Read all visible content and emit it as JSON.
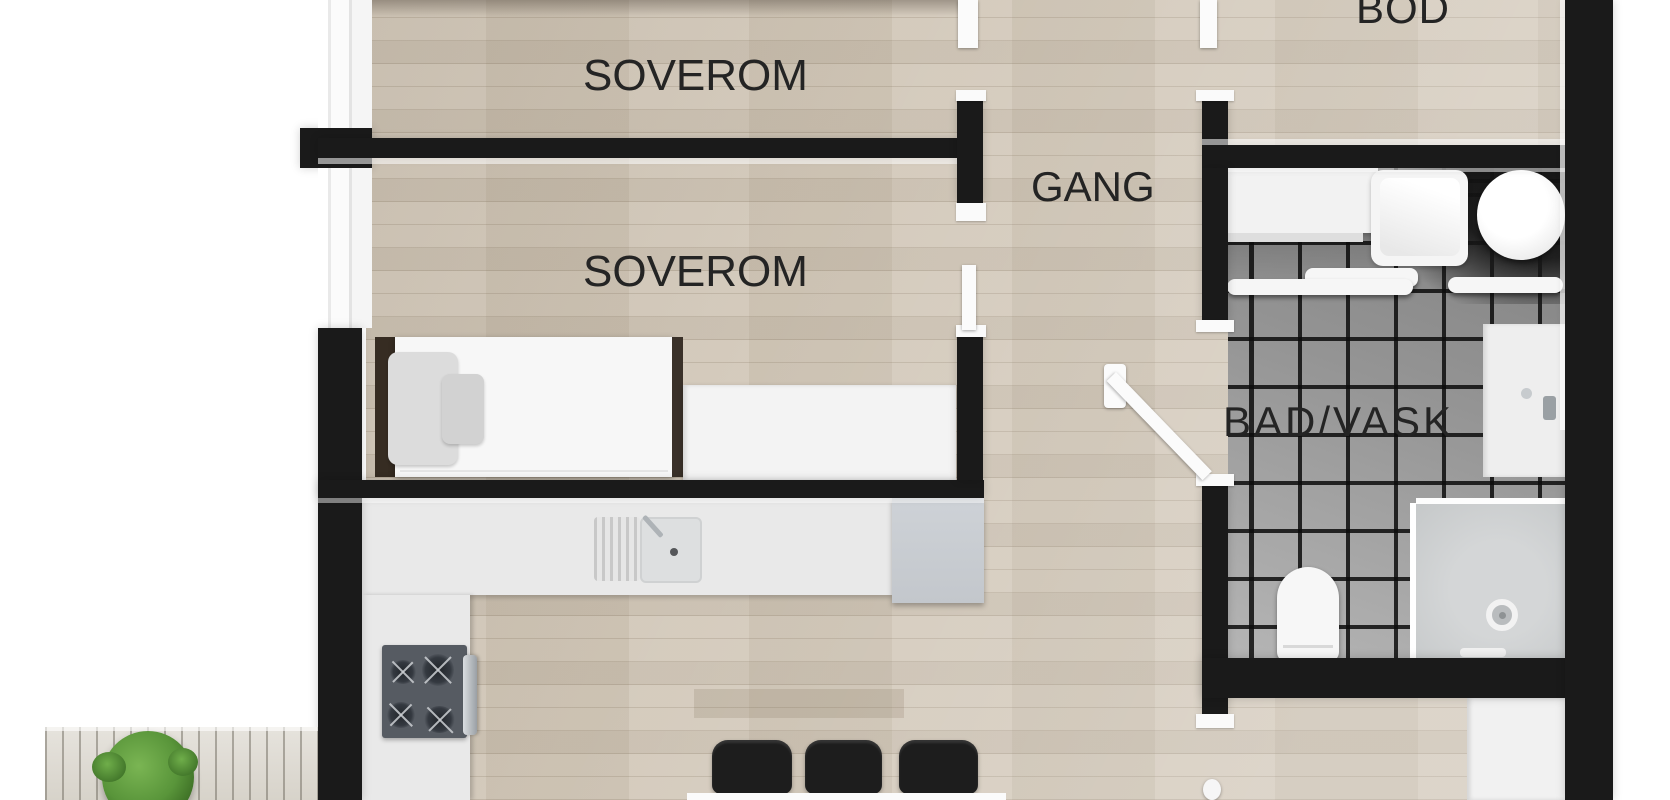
{
  "rooms": [
    {
      "id": "soverom-1",
      "label": "SOVEROM"
    },
    {
      "id": "soverom-2",
      "label": "SOVEROM"
    },
    {
      "id": "gang",
      "label": "GANG"
    },
    {
      "id": "bod",
      "label": "BOD"
    },
    {
      "id": "bad-vask",
      "label": "BAD/VASK"
    }
  ],
  "fixtures": [
    "bed",
    "pillow",
    "headboard",
    "desk-bench",
    "window",
    "kitchen-counter",
    "kitchen-sink",
    "kitchen-faucet",
    "cooktop",
    "oven-handle",
    "tall-cabinet",
    "dining-table",
    "dining-chair",
    "washing-machine",
    "water-heater",
    "bathroom-counter",
    "wall-shelf",
    "vanity-sink",
    "toilet",
    "shower",
    "shower-head",
    "door-leaf",
    "floor-lamp",
    "terrace-deck",
    "plant"
  ],
  "colors": {
    "wall": "#1a1a1a",
    "wood_floor": "#d2c8b9",
    "tile_floor": "#949494",
    "counter": "#e9e9e9",
    "fixture_white": "#f5f5f5",
    "chair_black": "#1d1d1d",
    "plant_green": "#5f9c3f",
    "label_text": "#242424"
  }
}
